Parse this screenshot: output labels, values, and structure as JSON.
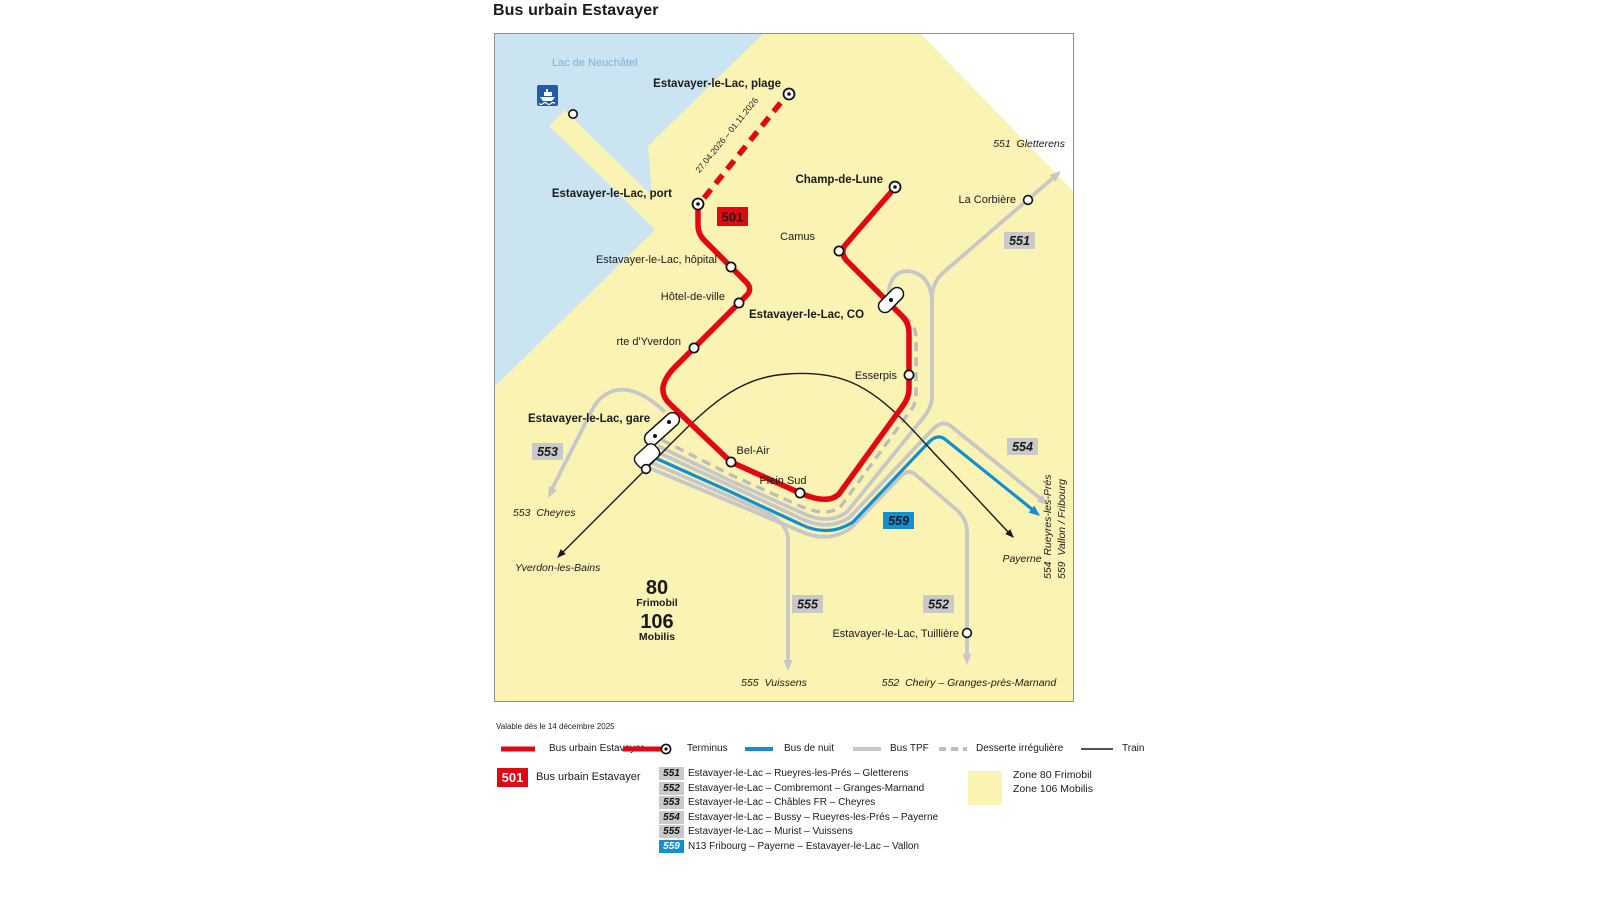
{
  "title": "Bus urbain Estavayer",
  "validity": "Valable dès le 14 décembre 2025",
  "colors": {
    "zone_yellow": "#FBF3B4",
    "lake_blue": "#CBE4F2",
    "bus_red": "#E30613",
    "night_bus_blue": "#1090D2",
    "tpf_gray": "#C7C7C7",
    "badge_gray": "#C9C9C9",
    "train_black": "#1a1a1a",
    "lake_label_blue": "#79B2DA",
    "ferry_icon_blue": "#1E5EA8"
  },
  "map": {
    "lake_label": "Lac de Neuchâtel",
    "seasonal_note": "27.04.2026 – 01.11.2026",
    "stops": {
      "plage": "Estavayer-le-Lac, plage",
      "port": "Estavayer-le-Lac, port",
      "champ_de_lune": "Champ-de-Lune",
      "camus": "Camus",
      "hopital": "Estavayer-le-Lac, hôpital",
      "hotel_de_ville": "Hôtel-de-ville",
      "co": "Estavayer-le-Lac, CO",
      "rte_yverdon": "rte d'Yverdon",
      "esserpis": "Esserpis",
      "gare": "Estavayer-le-Lac, gare",
      "bel_air": "Bel-Air",
      "plein_sud": "Plein Sud",
      "la_corbiere": "La Corbière",
      "tuilliere": "Estavayer-le-Lac, Tuillière"
    },
    "badges": {
      "b501": "501",
      "b551": "551",
      "b552": "552",
      "b553": "553",
      "b554": "554",
      "b555": "555",
      "b559": "559"
    },
    "destinations": {
      "gletterens": "551  Gletterens",
      "cheyres": "553  Cheyres",
      "yverdon": "Yverdon-les-Bains",
      "payerne": "Payerne",
      "vuissens": "555  Vuissens",
      "cheiry": "552  Cheiry – Granges-près-Marnand",
      "rueyres": "554  Rueyres-les-Prés",
      "vallon": "559  Vallon / Fribourg"
    },
    "zones": {
      "z80": "80",
      "z80_name": "Frimobil",
      "z106": "106",
      "z106_name": "Mobilis"
    }
  },
  "legend_lines": [
    {
      "label": "Bus urbain Estavayer"
    },
    {
      "label": "Terminus"
    },
    {
      "label": "Bus de nuit"
    },
    {
      "label": "Bus TPF"
    },
    {
      "label": "Desserte irrégulière"
    },
    {
      "label": "Train"
    }
  ],
  "legend_routes": {
    "r501": {
      "badge": "501",
      "label": "Bus urbain Estavayer"
    },
    "list": [
      {
        "badge": "551",
        "label": "Estavayer-le-Lac – Rueyres-les-Prés – Gletterens"
      },
      {
        "badge": "552",
        "label": "Estavayer-le-Lac – Combremont – Granges-Marnand"
      },
      {
        "badge": "553",
        "label": "Estavayer-le-Lac – Châbles FR – Cheyres"
      },
      {
        "badge": "554",
        "label": "Estavayer-le-Lac – Bussy – Rueyres-les-Prés – Payerne"
      },
      {
        "badge": "555",
        "label": "Estavayer-le-Lac – Murist – Vuissens"
      },
      {
        "badge": "559",
        "label": "N13 Fribourg – Payerne – Estavayer-le-Lac – Vallon"
      }
    ],
    "zones": [
      "Zone 80 Frimobil",
      "Zone 106 Mobilis"
    ]
  }
}
